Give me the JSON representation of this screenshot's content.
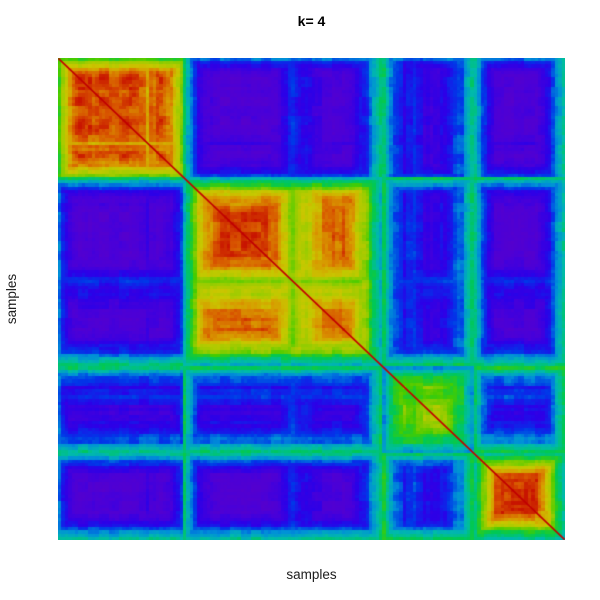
{
  "chart_data": {
    "type": "heatmap",
    "title": "k= 4",
    "xlabel": "samples",
    "ylabel": "samples",
    "legend_position": "none",
    "grid": false,
    "colormap": "rainbow-low-purple-high-red",
    "value_range": [
      0,
      1
    ],
    "n_samples": 150,
    "seed": 13,
    "clusters": [
      {
        "name": "cluster-1",
        "fraction": 0.245,
        "within_base": 0.95,
        "stability_profile": [
          0.5,
          0.85,
          0.95,
          0.9,
          0.97,
          0.88,
          0.94,
          0.9,
          0.8,
          0.92,
          0.85,
          0.55
        ]
      },
      {
        "name": "cluster-2",
        "fraction": 0.39,
        "within_base": 0.93,
        "stability_profile": [
          0.3,
          0.8,
          0.95,
          0.97,
          0.96,
          0.9,
          0.6,
          0.72,
          0.88,
          0.92,
          0.65,
          0.3
        ]
      },
      {
        "name": "cluster-3",
        "fraction": 0.178,
        "within_base": 0.82,
        "stability_profile": [
          0.3,
          0.55,
          0.68,
          0.6,
          0.75,
          0.8,
          0.72,
          0.62,
          0.5,
          0.33
        ]
      },
      {
        "name": "cluster-4",
        "fraction": 0.187,
        "within_base": 0.96,
        "stability_profile": [
          0.32,
          0.6,
          0.85,
          0.95,
          0.97,
          0.96,
          0.92,
          0.8,
          0.55,
          0.3
        ]
      }
    ],
    "between_base": [
      [
        0.0,
        0.05,
        0.05,
        0.05
      ],
      [
        0.05,
        0.0,
        0.07,
        0.05
      ],
      [
        0.05,
        0.07,
        0.0,
        0.1
      ],
      [
        0.05,
        0.05,
        0.1,
        0.0
      ]
    ],
    "within_floor": 0.22,
    "within_gain": 0.85,
    "cross_gain": 0.72,
    "cross_exp": 1.3,
    "block_noise": 0.06,
    "cell_noise": 0.03,
    "noise_group": 3,
    "diagonal_color": "#c00000",
    "palette_stops": [
      [
        0.0,
        "#5a00c8"
      ],
      [
        0.1,
        "#4a00d8"
      ],
      [
        0.2,
        "#2b00e8"
      ],
      [
        0.3,
        "#0038e8"
      ],
      [
        0.38,
        "#0090d8"
      ],
      [
        0.46,
        "#00bbaa"
      ],
      [
        0.54,
        "#00c855"
      ],
      [
        0.62,
        "#44cc00"
      ],
      [
        0.7,
        "#99cc00"
      ],
      [
        0.78,
        "#c8c800"
      ],
      [
        0.86,
        "#d89900"
      ],
      [
        0.93,
        "#d85500"
      ],
      [
        1.0,
        "#c81400"
      ]
    ]
  }
}
